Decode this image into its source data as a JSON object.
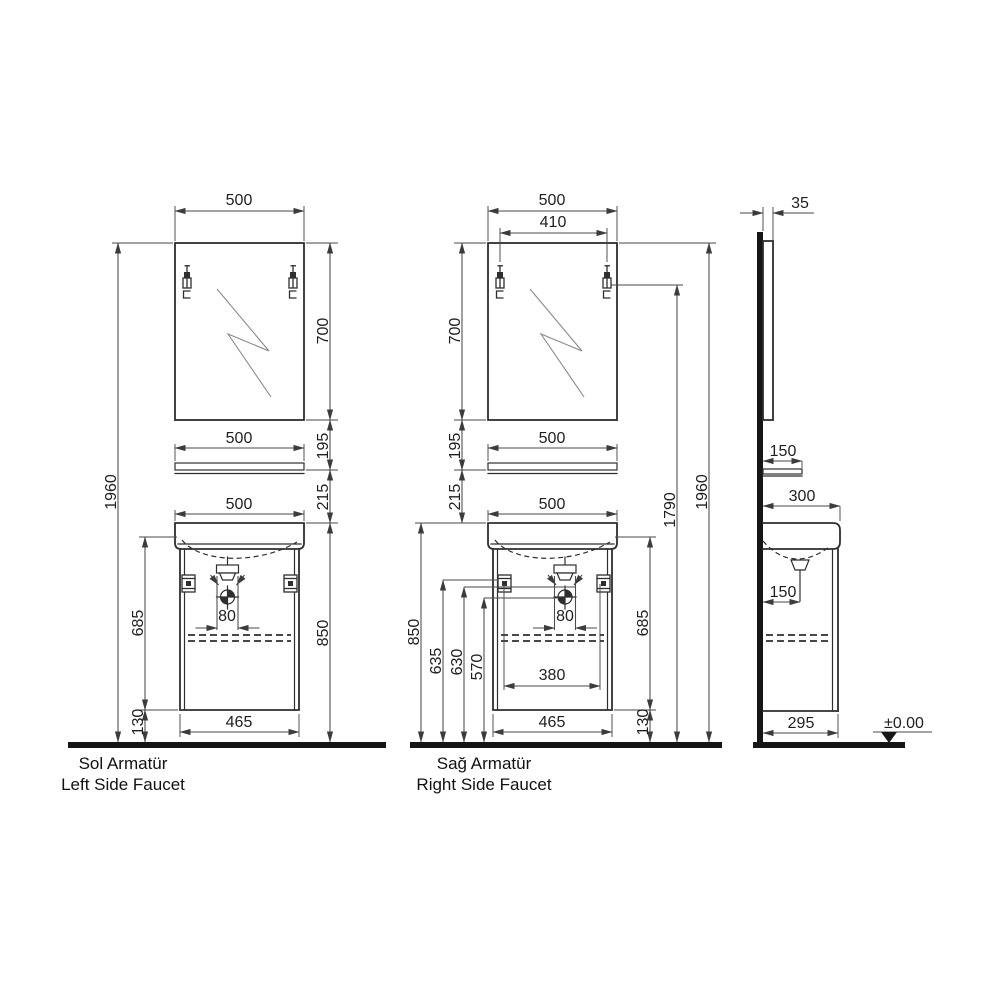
{
  "style": {
    "ink": "#2e2e2e",
    "dim_line": "#4a4a4a",
    "paper": "#ffffff"
  },
  "views": {
    "left_faucet": {
      "caption_line1": "Sol Armatür",
      "caption_line2": "Left Side Faucet",
      "dims": {
        "mirror_width": "500",
        "mirror_height": "700",
        "gap_mirror_shelf": "195",
        "shelf_width": "500",
        "gap_shelf_basin": "215",
        "basin_width": "500",
        "overall_height": "1960",
        "cabinet_height": "685",
        "drain_offset": "80",
        "basin_height": "850",
        "cabinet_width": "465",
        "plinth_height": "130"
      }
    },
    "right_faucet": {
      "caption_line1": "Sağ Armatür",
      "caption_line2": "Right Side Faucet",
      "dims": {
        "mirror_width": "500",
        "lamp_spacing": "410",
        "mirror_height": "700",
        "gap_mirror_shelf": "195",
        "shelf_width": "500",
        "gap_shelf_basin": "215",
        "basin_width": "500",
        "basin_height": "850",
        "bracket_height": "635",
        "faucet_height": "630",
        "drain_height": "570",
        "bracket_spacing": "380",
        "drain_offset": "80",
        "cabinet_height": "685",
        "cabinet_width": "465",
        "plinth_height": "130",
        "lamp_height": "1790",
        "overall_height": "1960"
      }
    },
    "side": {
      "dims": {
        "mirror_depth": "35",
        "shelf_depth": "150",
        "basin_depth": "300",
        "drain_wall_distance": "150",
        "cabinet_depth": "295",
        "floor_level": "±0.00"
      }
    }
  }
}
